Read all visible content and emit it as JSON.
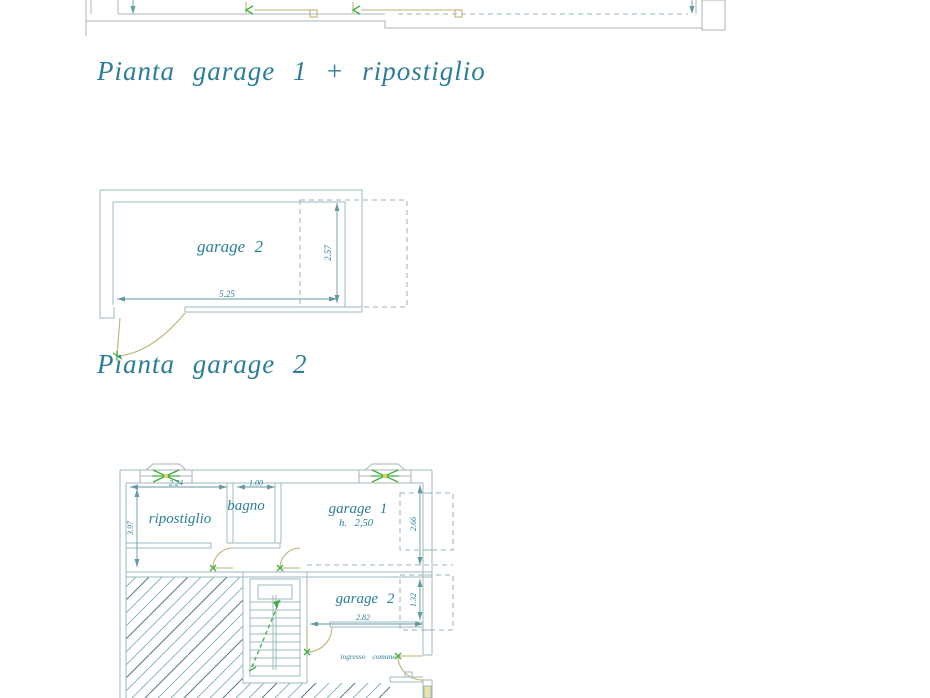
{
  "document": {
    "kind": "architectural floor plan sheet",
    "background": "#ffffff"
  },
  "titles": {
    "plan1": "Pianta garage 1 + ripostiglio",
    "plan2": "Pianta garage 2"
  },
  "plan_garage2": {
    "room_label": "garage 2",
    "dim_width": "5.25",
    "dim_height": "2.57"
  },
  "plan_lower": {
    "rooms": {
      "ripostiglio": "ripostiglio",
      "bagno": "bagno",
      "garage1": "garage 1",
      "garage1_note": "h. 2,50",
      "garage2": "garage 2",
      "ingresso": "ingresso comune"
    },
    "dims": {
      "ripostiglio_width": "2.24",
      "bagno_width": "1.00",
      "left_depth": "3.97",
      "garage1_opening": "2.66",
      "garage2_opening": "1.32",
      "garage2_width": "2.82"
    }
  },
  "colors": {
    "wall_line": "#9db8c0",
    "text_teal": "#2b7e95",
    "dimension": "#629aa6",
    "door_olive": "#bfb172",
    "window_green": "#3fae3f",
    "window_yellow": "#e9e5a6"
  }
}
